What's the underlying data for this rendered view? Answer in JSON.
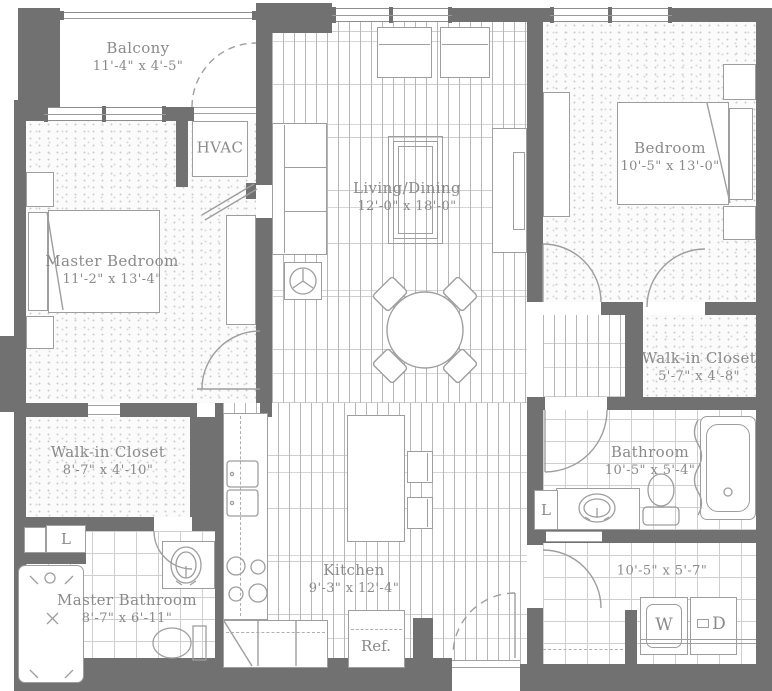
{
  "colors": {
    "wall": "#717171",
    "line": "#9e9e9e",
    "text": "#8a8a8a"
  },
  "rooms": {
    "balcony": {
      "name": "Balcony",
      "dims": "11'-4\" x 4'-5\""
    },
    "hvac": {
      "name": "HVAC"
    },
    "living_dining": {
      "name": "Living/Dining",
      "dims": "12'-0\" x 18'-0\""
    },
    "bedroom": {
      "name": "Bedroom",
      "dims": "10'-5\" x 13'-0\""
    },
    "master_bedroom": {
      "name": "Master Bedroom",
      "dims": "11'-2\" x 13'-4\""
    },
    "walk_in_closet_master": {
      "name": "Walk-in Closet",
      "dims": "8'-7\" x 4'-10\""
    },
    "walk_in_closet_hall": {
      "name": "Walk-in Closet",
      "dims": "5'-7\" x 4'-8\""
    },
    "bathroom": {
      "name": "Bathroom",
      "dims": "10'-5\" x 5'-4\""
    },
    "master_bathroom": {
      "name": "Master Bathroom",
      "dims": "8'-7\" x 6'-11\""
    },
    "kitchen": {
      "name": "Kitchen",
      "dims": "9'-3\" x 12'-4\""
    },
    "laundry": {
      "dims": "10'-5\" x 5'-7\""
    }
  },
  "fixtures": {
    "refrigerator": "Ref.",
    "washer": "W",
    "dryer": "D",
    "linen_master": "L",
    "linen_bath": "L"
  }
}
